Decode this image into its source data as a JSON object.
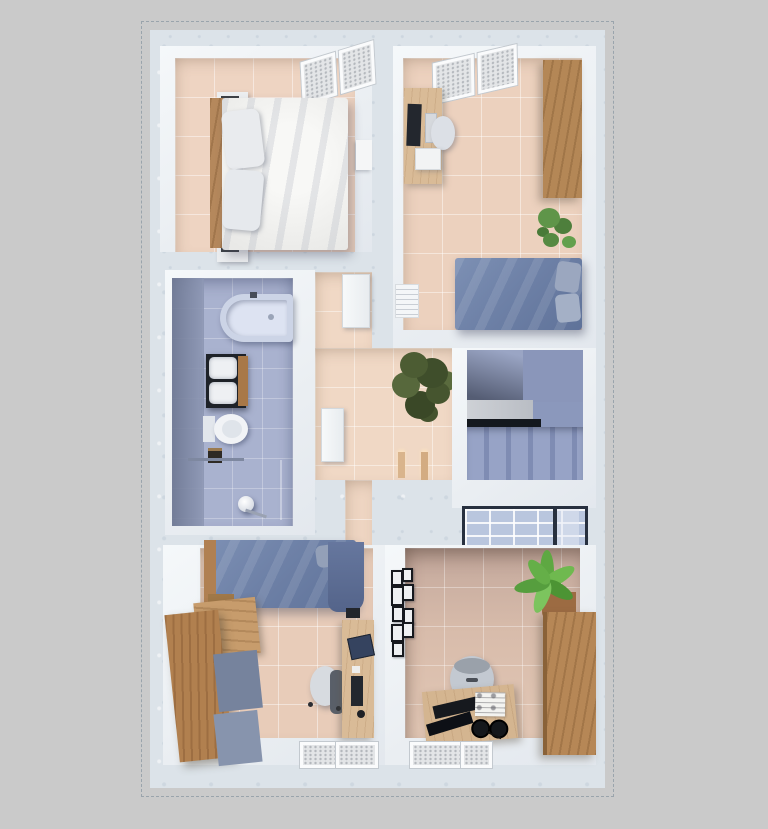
{
  "app": {
    "title": "3D apartment floor plan - top-down render"
  },
  "canvas": {
    "width": 768,
    "height": 829,
    "background": "#cacaca"
  },
  "palette": {
    "outer_wall_marble": "#dce3e9",
    "inner_wall_white": "#f1f4f6",
    "warm_tile_floor": "#ecd2c0",
    "bathroom_tile": "#a9b2cf",
    "blue_bedding": "#7286ac",
    "white_bedding": "#f0f0ee",
    "wood": "#b48756",
    "stairwell": "#8b98bc",
    "plant_dark_green": "#4a5a35",
    "plant_bright_green": "#63aa49",
    "glass_panel": "#b9c6de"
  },
  "rooms": [
    {
      "id": "bedroom-top-left",
      "name": "Bedroom (top left)",
      "furniture": [
        "double bed with white duvet and pillows",
        "wooden headboard",
        "nightstand with lamp x2",
        "wall shelf",
        "slanted window with blinds"
      ]
    },
    {
      "id": "bedroom-top-right",
      "name": "Bedroom / office (top right)",
      "furniture": [
        "desk with monitor, keyboard and printer",
        "desk chair",
        "wooden wardrobe",
        "potted plant",
        "double bed with blue duvet and two pillows",
        "slanted window with blinds",
        "louvered panel"
      ]
    },
    {
      "id": "bathroom",
      "name": "Bathroom",
      "furniture": [
        "bathtub",
        "double-sink vanity on dark counter",
        "toilet",
        "waste bin",
        "towel rail",
        "shower with round lamp",
        "blue tiled floor and walls"
      ]
    },
    {
      "id": "hallway",
      "name": "Hallway",
      "furniture": [
        "potted tree",
        "two floor candles",
        "open door leaf",
        "bathroom door"
      ]
    },
    {
      "id": "staircase",
      "name": "Staircase",
      "furniture": [
        "upper flight",
        "mid landing with dark edge",
        "lower steps",
        "glass balustrade panel"
      ]
    },
    {
      "id": "bedroom-bottom-left",
      "name": "Bedroom (bottom left)",
      "furniture": [
        "single bed with blue duvet",
        "large wooden wardrobe",
        "desk with laptop, keyboard and mouse",
        "office chair",
        "two windows with blinds"
      ]
    },
    {
      "id": "bedroom-bottom-right",
      "name": "Bedroom / study (bottom right)",
      "furniture": [
        "gallery wall of black picture frames",
        "bright potted plant",
        "wooden sideboard",
        "desk with keyboard, papers and headphones",
        "grey chair",
        "two windows with blinds"
      ]
    }
  ]
}
